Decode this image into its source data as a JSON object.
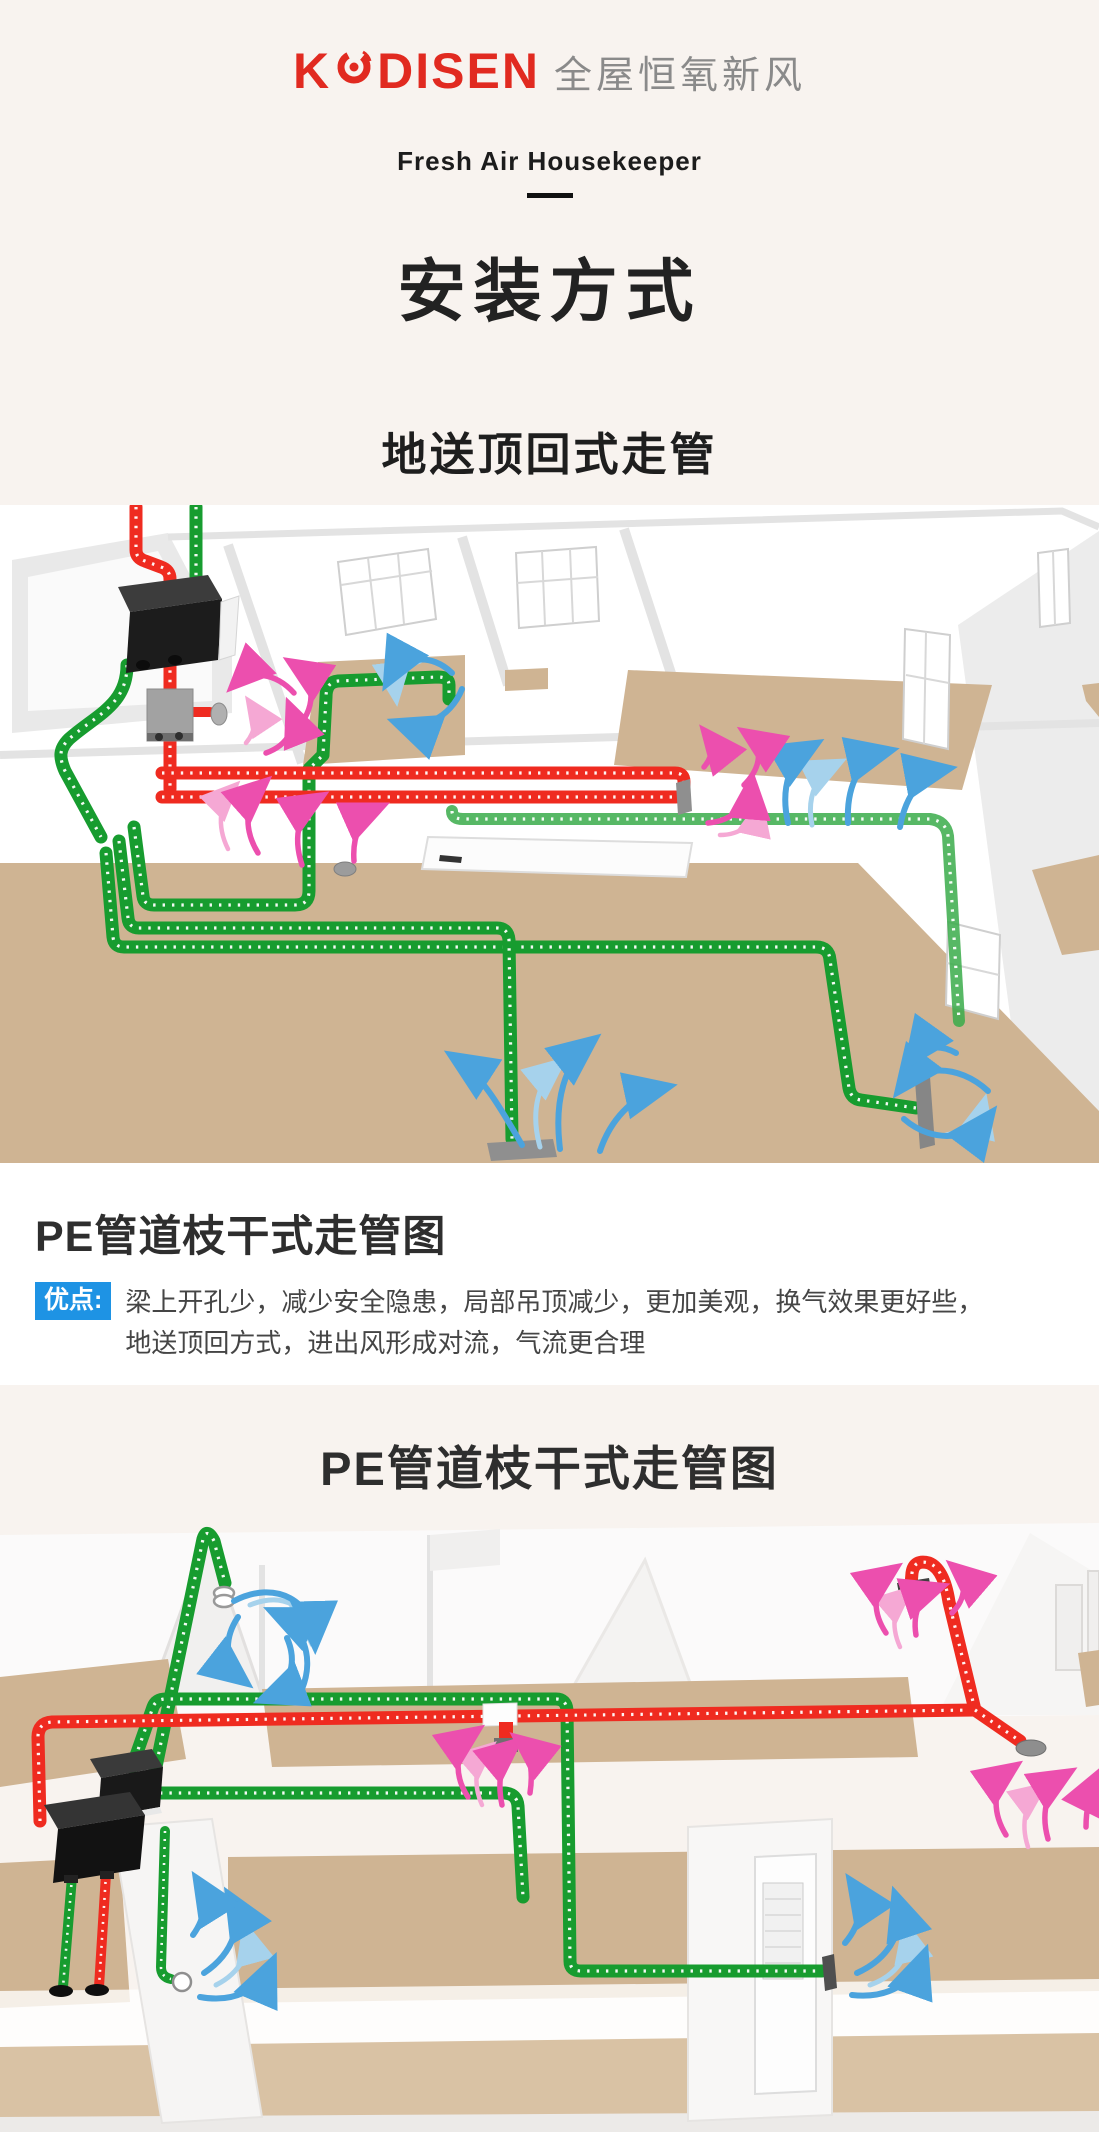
{
  "header": {
    "logo_prefix": "K",
    "logo_suffix": "DISEN",
    "logo_tagline": "全屋恒氧新风",
    "subtitle": "Fresh Air Housekeeper"
  },
  "hero": {
    "title": "安装方式",
    "subtitle": "地送顶回式走管"
  },
  "section1": {
    "caption_title": "PE管道枝干式走管图",
    "advantage_label": "优点:",
    "advantage_line1": "梁上开孔少，减少安全隐患，局部吊顶减少，更加美观，换气效果更好些，",
    "advantage_line2": "地送顶回方式，进出风形成对流，气流更合理"
  },
  "section2": {
    "title": "PE管道枝干式走管图"
  },
  "colors": {
    "logo_red": "#e12a20",
    "logo_text_gray": "#8a8a8a",
    "badge_blue": "#1e93e4",
    "page_cream": "#f8f3ef",
    "panel_white": "#ffffff",
    "duct_green": "#179c2f",
    "duct_green_light": "#3aab4a",
    "duct_red": "#ef2b20",
    "arrow_blue": "#4ba3dd",
    "arrow_blue_light": "#a6d2ec",
    "arrow_pink": "#ec4fae",
    "arrow_pink_light": "#f5a8d4",
    "floor_tan": "#cfb493",
    "floor_tan_light": "#d9c2a4",
    "unit_black": "#1c1c1c",
    "fitting_gray": "#9a9a9a"
  }
}
